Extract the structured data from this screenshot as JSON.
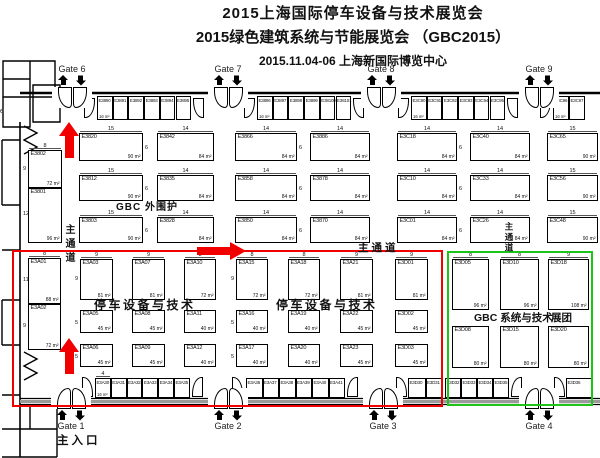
{
  "title": {
    "line1": "2015上海国际停车设备与技术展览会",
    "line2": "2015绿色建筑系统与节能展览会 （GBC2015）",
    "line3": "2015.11.04-06  上海新国际博览中心"
  },
  "colors": {
    "accent_red": "#f20000",
    "accent_green": "#1cc41c",
    "wall_gray": "#9a9a9a"
  },
  "labels": {
    "gbc_outer_wall": "GBC 外围护",
    "parking_zone_1": "停车设备与技术",
    "parking_zone_2": "停车设备与技术",
    "gbc_system": "GBC 系统与技术",
    "exhibition_group": "展团",
    "main_aisle_vertical": "主通道",
    "main_aisle_vertical_2": "主通道",
    "main_aisle_horizontal": "主通道",
    "main_entrance": "主入口",
    "edge_text": "e"
  },
  "gates": {
    "top": [
      {
        "label": "Gate 6",
        "cx": 72
      },
      {
        "label": "Gate 7",
        "cx": 228
      },
      {
        "label": "Gate 8",
        "cx": 381
      },
      {
        "label": "Gate 9",
        "cx": 539
      }
    ],
    "bottom": [
      {
        "label": "Gate 1",
        "cx": 71
      },
      {
        "label": "Gate 2",
        "cx": 228
      },
      {
        "label": "Gate 3",
        "cx": 383
      },
      {
        "label": "Gate 4",
        "cx": 539
      }
    ]
  },
  "booths": [
    {
      "id": "E3802",
      "x": 28,
      "y": 150,
      "w": 34,
      "h": 38,
      "area": "72 m²",
      "top": "8",
      "left": "9"
    },
    {
      "id": "E3801",
      "x": 28,
      "y": 188,
      "w": 34,
      "h": 55,
      "area": "96 m²",
      "left": "12"
    },
    {
      "id": "E3820",
      "x": 79,
      "y": 133,
      "w": 64,
      "h": 28,
      "area": "90 m²",
      "top": "15",
      "right": "6"
    },
    {
      "id": "E3812",
      "x": 79,
      "y": 175,
      "w": 64,
      "h": 26,
      "area": "90 m²",
      "top": "15",
      "right": "6"
    },
    {
      "id": "E3803",
      "x": 79,
      "y": 217,
      "w": 64,
      "h": 26,
      "area": "90 m²",
      "top": "15",
      "right": "6"
    },
    {
      "id": "E3842",
      "x": 157,
      "y": 133,
      "w": 57,
      "h": 28,
      "area": "84 m²",
      "top": "14"
    },
    {
      "id": "E3835",
      "x": 157,
      "y": 175,
      "w": 57,
      "h": 26,
      "area": "84 m²",
      "top": "14"
    },
    {
      "id": "E3828",
      "x": 157,
      "y": 217,
      "w": 57,
      "h": 26,
      "area": "84 m²",
      "top": "14"
    },
    {
      "id": "E3866",
      "x": 235,
      "y": 133,
      "w": 62,
      "h": 28,
      "area": "84 m²",
      "top": "14",
      "right": "6"
    },
    {
      "id": "E3858",
      "x": 235,
      "y": 175,
      "w": 62,
      "h": 26,
      "area": "84 m²",
      "top": "14",
      "right": "6"
    },
    {
      "id": "E3850",
      "x": 235,
      "y": 217,
      "w": 62,
      "h": 26,
      "area": "84 m²",
      "top": "14",
      "right": "6"
    },
    {
      "id": "E3886",
      "x": 310,
      "y": 133,
      "w": 60,
      "h": 28,
      "area": "84 m²",
      "top": "14"
    },
    {
      "id": "E3878",
      "x": 310,
      "y": 175,
      "w": 60,
      "h": 26,
      "area": "84 m²",
      "top": "14"
    },
    {
      "id": "E3870",
      "x": 310,
      "y": 217,
      "w": 60,
      "h": 26,
      "area": "84 m²",
      "top": "14"
    },
    {
      "id": "E3C18",
      "x": 397,
      "y": 133,
      "w": 60,
      "h": 28,
      "area": "84 m²",
      "top": "14",
      "right": "6"
    },
    {
      "id": "E3C10",
      "x": 397,
      "y": 175,
      "w": 60,
      "h": 26,
      "area": "84 m²",
      "top": "14",
      "right": "6"
    },
    {
      "id": "E3C01",
      "x": 397,
      "y": 217,
      "w": 60,
      "h": 26,
      "area": "84 m²",
      "top": "14",
      "right": "6"
    },
    {
      "id": "E3C40",
      "x": 470,
      "y": 133,
      "w": 60,
      "h": 28,
      "area": "84 m²",
      "top": "14"
    },
    {
      "id": "E3C33",
      "x": 470,
      "y": 175,
      "w": 60,
      "h": 26,
      "area": "84 m²",
      "top": "14"
    },
    {
      "id": "E3C26",
      "x": 470,
      "y": 217,
      "w": 60,
      "h": 26,
      "area": "84 m²",
      "top": "14"
    },
    {
      "id": "E3C65",
      "x": 547,
      "y": 133,
      "w": 51,
      "h": 28,
      "area": "90 m²",
      "top": "15"
    },
    {
      "id": "E3C56",
      "x": 547,
      "y": 175,
      "w": 51,
      "h": 26,
      "area": "90 m²",
      "top": "15"
    },
    {
      "id": "E3C48",
      "x": 547,
      "y": 217,
      "w": 51,
      "h": 26,
      "area": "90 m²",
      "top": "15"
    },
    {
      "id": "E3A01",
      "x": 28,
      "y": 258,
      "w": 33,
      "h": 46,
      "area": "88 m²",
      "top": "8",
      "left": "11"
    },
    {
      "id": "E3A02",
      "x": 28,
      "y": 304,
      "w": 33,
      "h": 46,
      "area": "72 m²",
      "left": "9"
    },
    {
      "id": "E3A03",
      "x": 80,
      "y": 259,
      "w": 33,
      "h": 41,
      "area": "81 m²",
      "top": "9",
      "left": "9"
    },
    {
      "id": "E3A05",
      "x": 80,
      "y": 310,
      "w": 33,
      "h": 23,
      "area": "45 m²",
      "left": "5"
    },
    {
      "id": "E3A06",
      "x": 80,
      "y": 344,
      "w": 33,
      "h": 23,
      "area": "45 m²",
      "left": "5"
    },
    {
      "id": "E3A07",
      "x": 132,
      "y": 259,
      "w": 33,
      "h": 41,
      "area": "81 m²",
      "top": "9"
    },
    {
      "id": "E3A08",
      "x": 132,
      "y": 310,
      "w": 33,
      "h": 23,
      "area": "45 m²"
    },
    {
      "id": "E3A09",
      "x": 132,
      "y": 344,
      "w": 33,
      "h": 23,
      "area": "45 m²"
    },
    {
      "id": "E3A10",
      "x": 184,
      "y": 259,
      "w": 32,
      "h": 41,
      "area": "72 m²",
      "top": "8"
    },
    {
      "id": "E3A11",
      "x": 184,
      "y": 310,
      "w": 32,
      "h": 23,
      "area": "40 m²"
    },
    {
      "id": "E3A12",
      "x": 184,
      "y": 344,
      "w": 32,
      "h": 23,
      "area": "40 m²"
    },
    {
      "id": "E3A15",
      "x": 236,
      "y": 259,
      "w": 32,
      "h": 41,
      "area": "72 m²",
      "top": "8",
      "left": "9"
    },
    {
      "id": "E3A16",
      "x": 236,
      "y": 310,
      "w": 32,
      "h": 23,
      "area": "40 m²",
      "left": "5"
    },
    {
      "id": "E3A17",
      "x": 236,
      "y": 344,
      "w": 32,
      "h": 23,
      "area": "40 m²",
      "left": "5"
    },
    {
      "id": "E3A18",
      "x": 288,
      "y": 259,
      "w": 32,
      "h": 41,
      "area": "72 m²",
      "top": "8"
    },
    {
      "id": "E3A19",
      "x": 288,
      "y": 310,
      "w": 32,
      "h": 23,
      "area": "40 m²"
    },
    {
      "id": "E3A20",
      "x": 288,
      "y": 344,
      "w": 32,
      "h": 23,
      "area": "40 m²"
    },
    {
      "id": "E3A21",
      "x": 340,
      "y": 259,
      "w": 33,
      "h": 41,
      "area": "81 m²",
      "top": "9"
    },
    {
      "id": "E3A22",
      "x": 340,
      "y": 310,
      "w": 33,
      "h": 23,
      "area": "45 m²"
    },
    {
      "id": "E3A23",
      "x": 340,
      "y": 344,
      "w": 33,
      "h": 23,
      "area": "45 m²"
    },
    {
      "id": "E3D01",
      "x": 395,
      "y": 259,
      "w": 33,
      "h": 41,
      "area": "81 m²",
      "top": "9"
    },
    {
      "id": "E3D02",
      "x": 395,
      "y": 310,
      "w": 33,
      "h": 23,
      "area": "45 m²"
    },
    {
      "id": "E3D03",
      "x": 395,
      "y": 344,
      "w": 33,
      "h": 23,
      "area": "45 m²"
    },
    {
      "id": "E3D05",
      "x": 452,
      "y": 259,
      "w": 37,
      "h": 51,
      "area": "96 m²",
      "top": "8"
    },
    {
      "id": "E3D10",
      "x": 500,
      "y": 259,
      "w": 39,
      "h": 51,
      "area": "96 m²",
      "top": "8"
    },
    {
      "id": "E3D18",
      "x": 548,
      "y": 259,
      "w": 41,
      "h": 51,
      "area": "108 m²",
      "top": "9"
    },
    {
      "id": "E3D08",
      "x": 452,
      "y": 326,
      "w": 37,
      "h": 42,
      "area": "80 m²"
    },
    {
      "id": "E3D15",
      "x": 500,
      "y": 326,
      "w": 39,
      "h": 42,
      "area": "80 m²"
    },
    {
      "id": "E3D20",
      "x": 548,
      "y": 326,
      "w": 41,
      "h": 42,
      "area": "80 m²"
    }
  ],
  "top_strips": [
    {
      "x": 97,
      "y": 96,
      "w": 15.7,
      "h": 24,
      "leaves": [
        84,
        193
      ],
      "booths": [
        {
          "id": "E3890",
          "area": "16 m²"
        },
        {
          "id": "E3891"
        },
        {
          "id": "E3892"
        },
        {
          "id": "E3893"
        },
        {
          "id": "E3894"
        },
        {
          "id": "E3895"
        }
      ]
    },
    {
      "x": 257,
      "y": 96,
      "w": 15.7,
      "h": 24,
      "leaves": [
        244,
        353
      ],
      "booths": [
        {
          "id": "E3896",
          "area": "16 m²"
        },
        {
          "id": "E3897"
        },
        {
          "id": "E3898"
        },
        {
          "id": "E3899"
        },
        {
          "id": "E38100"
        },
        {
          "id": "E38101"
        }
      ]
    },
    {
      "x": 411,
      "y": 96,
      "w": 15.7,
      "h": 24,
      "leaves": [
        398,
        507
      ],
      "booths": [
        {
          "id": "E3C90",
          "area": "16 m²"
        },
        {
          "id": "E3C91"
        },
        {
          "id": "E3C92"
        },
        {
          "id": "E3C93"
        },
        {
          "id": "E3C94"
        },
        {
          "id": "E3C95"
        }
      ]
    },
    {
      "x": 553,
      "y": 96,
      "w": 16,
      "h": 24,
      "leaves": [
        540
      ],
      "booths": [
        {
          "id": "E3C96",
          "area": "16 m²"
        },
        {
          "id": "E3C97"
        }
      ]
    }
  ],
  "bottom_strips": [
    {
      "x": 95,
      "y": 378,
      "w": 15.8,
      "h": 20,
      "leaves": [
        82,
        192
      ],
      "booths": [
        {
          "id": "E3A30",
          "area": "16 m²",
          "top": "4"
        },
        {
          "id": "E3A31"
        },
        {
          "id": "E3A32"
        },
        {
          "id": "E3A33"
        },
        {
          "id": "E3A34"
        },
        {
          "id": "E3A35"
        }
      ]
    },
    {
      "x": 246,
      "y": 378,
      "w": 16.5,
      "h": 20,
      "leaves": [
        232,
        347
      ],
      "booths": [
        {
          "id": "E3A36"
        },
        {
          "id": "E3A37"
        },
        {
          "id": "E3A38"
        },
        {
          "id": "E3A39"
        },
        {
          "id": "E3A40"
        },
        {
          "id": "E3A41"
        }
      ]
    },
    {
      "x": 408,
      "y": 378,
      "w": 17.5,
      "h": 20,
      "leaves": [
        396
      ],
      "booths": [
        {
          "id": "E3D30"
        },
        {
          "id": "E3D31"
        }
      ]
    },
    {
      "x": 445,
      "y": 378,
      "w": 16,
      "h": 20,
      "leaves": [
        511
      ],
      "booths": [
        {
          "id": "E3D32"
        },
        {
          "id": "E3D33"
        },
        {
          "id": "E3D34"
        },
        {
          "id": "E3D35"
        }
      ]
    },
    {
      "x": 566,
      "y": 378,
      "w": 27,
      "h": 20,
      "leaves": [
        554
      ],
      "booths": [
        {
          "id": "E3D36"
        }
      ]
    }
  ]
}
